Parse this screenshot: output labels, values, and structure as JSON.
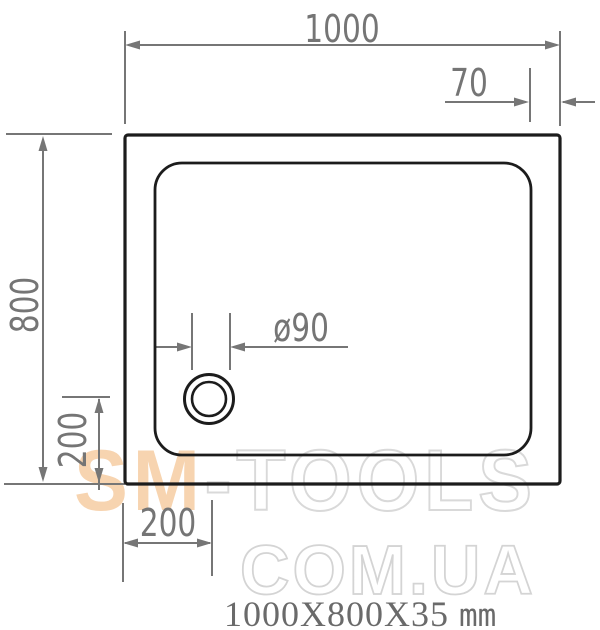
{
  "drawing": {
    "type": "shower-tray-top-view-technical-drawing",
    "dim_width": "1000",
    "dim_rim": "70",
    "dim_height": "800",
    "dim_drain": "ø90",
    "dim_offset_left": "200",
    "dim_offset_bottom": "200"
  },
  "watermark": {
    "sm": "SM",
    "tools": "-TOOLS",
    "line2": "COM.UA"
  },
  "caption": {
    "size": "1000X800X35",
    "unit": "mm"
  },
  "colors": {
    "outline_black": "#1c1c1c",
    "dimension_gray": "#767676",
    "watermark_peach": "#f7d4b0",
    "watermark_outline": "#d9d9d9",
    "caption_gray": "#6a6a6a",
    "background": "#ffffff"
  }
}
